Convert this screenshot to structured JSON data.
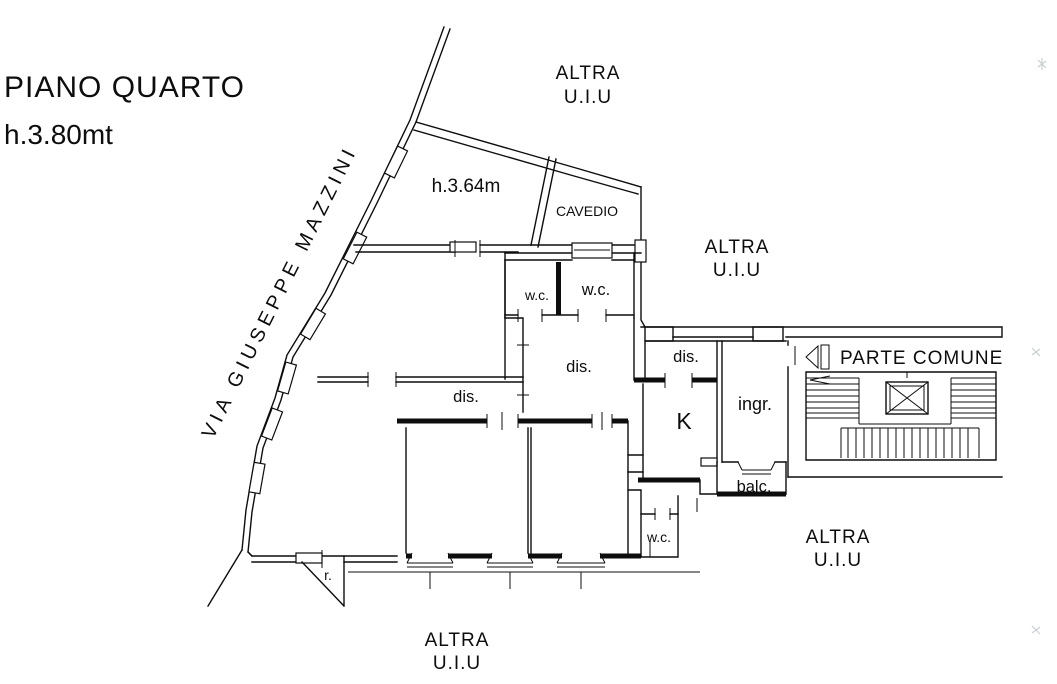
{
  "page": {
    "title_line1": "PIANO QUARTO",
    "title_line2": "h.3.80mt"
  },
  "street": {
    "name": "VIA GIUSEPPE MAZZINI"
  },
  "common_area": {
    "label": "PARTE COMUNE"
  },
  "external_units": {
    "top": {
      "line1": "ALTRA",
      "line2": "U.I.U"
    },
    "right": {
      "line1": "ALTRA",
      "line2": "U.I.U"
    },
    "bottom_right": {
      "line1": "ALTRA",
      "line2": "U.I.U"
    },
    "bottom": {
      "line1": "ALTRA",
      "line2": "U.I.U"
    }
  },
  "rooms": {
    "attic_height": "h.3.64m",
    "cavedio": "CAVEDIO",
    "wc_top_left": "w.c.",
    "wc_top_right": "w.c.",
    "wc_bottom": "w.c.",
    "dis_left": "dis.",
    "dis_center": "dis.",
    "dis_right": "dis.",
    "entrance": "ingr.",
    "kitchen": "K",
    "balcony": "balc.",
    "storage": "r."
  },
  "colors": {
    "ink": "#0d0d0d",
    "paper": "#ffffff"
  }
}
